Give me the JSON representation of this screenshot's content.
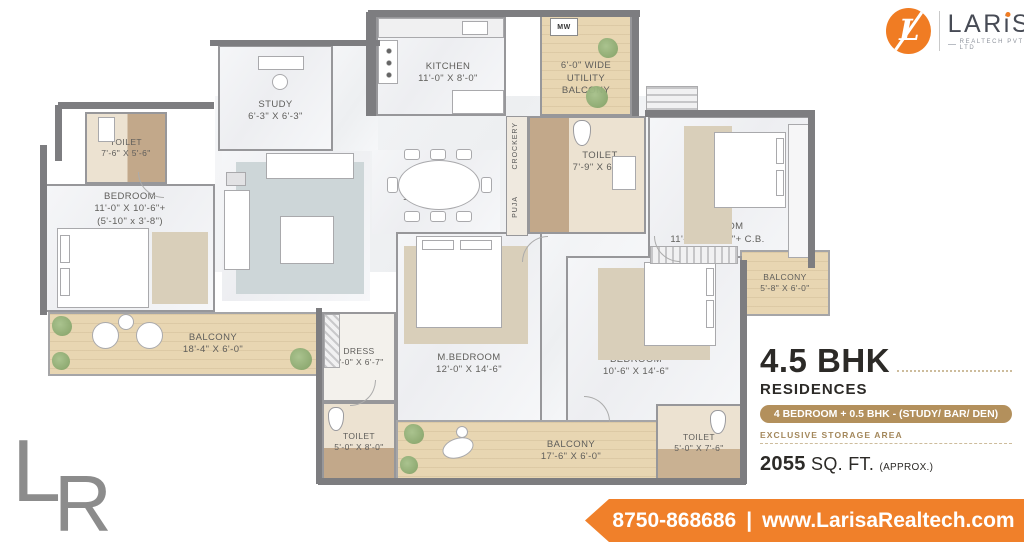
{
  "brand": {
    "monogram": "L",
    "name_part1": "LAR",
    "name_i": "i",
    "name_part2": "SA",
    "subtext": "REALTECH PVT LTD"
  },
  "watermark": {
    "letter_l": "L",
    "letter_r": "R"
  },
  "info": {
    "title": "4.5 BHK",
    "subtitle": "RESIDENCES",
    "badge": "4 BEDROOM + 0.5 BHK - (STUDY/ BAR/ DEN)",
    "storage_note": "EXCLUSIVE STORAGE AREA",
    "area_value": "2055",
    "area_unit": "SQ. FT.",
    "area_approx": "(APPROX.)"
  },
  "footer": {
    "phone": "8750-868686",
    "separator": "|",
    "website": "www.LarisaRealtech.com"
  },
  "plan": {
    "appliance_microwave": "MW",
    "strip_crockery": "CROCKERY",
    "strip_puja": "PUJA",
    "rooms": [
      {
        "name": "TOILET",
        "dims": "7'-6\" X 5'-6\""
      },
      {
        "name": "BEDROOM",
        "dims": "11'-0\" X 10'-6\"+",
        "extra": "(5'-10\" x 3'-8\")"
      },
      {
        "name": "STUDY",
        "dims": "6'-3\" X 6'-3\""
      },
      {
        "name": "KITCHEN",
        "dims": "11'-0\" X 8'-0\""
      },
      {
        "name": "6'-0\" WIDE UTILITY BALCONY"
      },
      {
        "name": "DRAWING",
        "dims": "11'-6\" X 16'-3\""
      },
      {
        "name": "DINING",
        "dims": "10'-9\" X 10'-6\""
      },
      {
        "name": "TOILET",
        "dims": "7'-9\" X 6'-6\""
      },
      {
        "name": "BEDROOM",
        "dims": "11'-6\" X 10'-6\"+ C.B."
      },
      {
        "name": "BALCONY",
        "dims": "5'-8\" X 6'-0\""
      },
      {
        "name": "BALCONY",
        "dims": "18'-4\" X 6'-0\""
      },
      {
        "name": "DRESS",
        "dims": "5'-0\" X 6'-7\""
      },
      {
        "name": "M.BEDROOM",
        "dims": "12'-0\" X 14'-6\""
      },
      {
        "name": "BEDROOM",
        "dims": "10'-6\" X 14'-6\""
      },
      {
        "name": "TOILET",
        "dims": "5'-0\" X 8'-0\""
      },
      {
        "name": "BALCONY",
        "dims": "17'-6\" X 6'-0\""
      },
      {
        "name": "TOILET",
        "dims": "5'-0\" X 7'-6\""
      }
    ]
  }
}
